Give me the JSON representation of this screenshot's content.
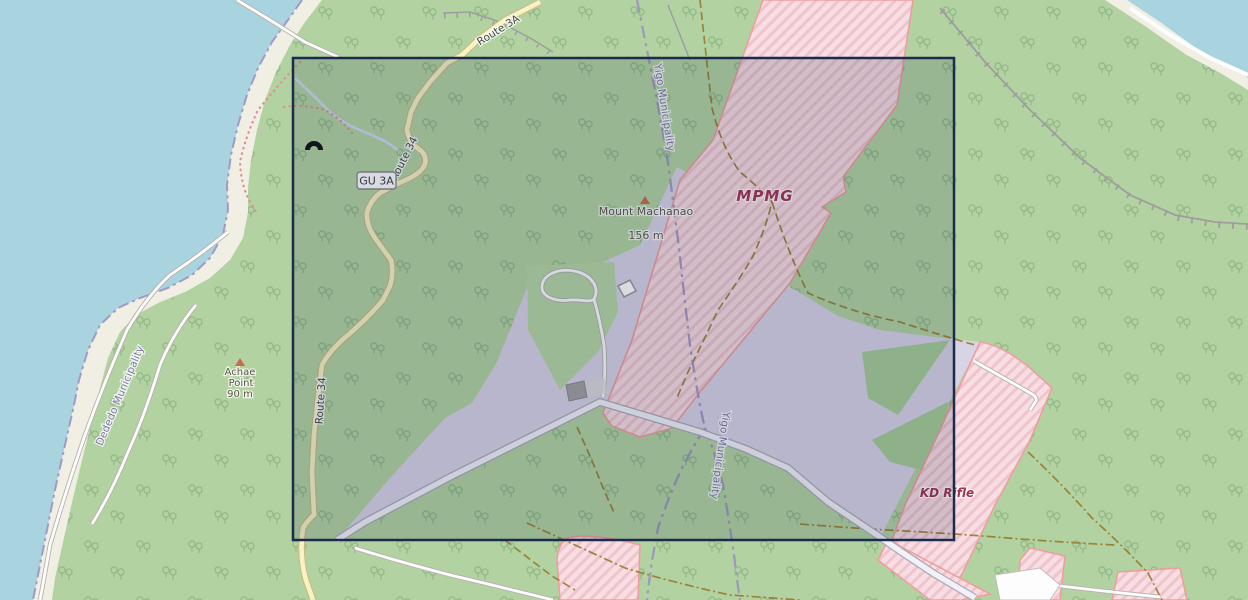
{
  "map": {
    "type": "openstreetmap-style terrain map with selection overlay",
    "labels": {
      "route_3a": "Route 3A",
      "route_34_upper": "Route 34",
      "route_34_lower": "Route 34",
      "shield_gu3a": "GU 3A",
      "peak1_name": "Mount Machanao",
      "peak1_elev": "156 m",
      "peak2_name_l1": "Achae",
      "peak2_name_l2": "Point",
      "peak2_elev": "90 m",
      "area_mpmg": "MPMG",
      "area_kd_rifle": "KD Rifle",
      "boundary_yigo_top": "Yigo Municipality",
      "boundary_yigo_lower": "Yigo Municipality",
      "boundary_dededo": "Dededo Municipality"
    },
    "icons": {
      "cave_entrance": "cave-entrance-icon",
      "peak_markers": "peak-triangle-icon"
    },
    "selection": {
      "x": 293,
      "y": 58,
      "width": 661,
      "height": 482
    },
    "colors": {
      "water": "#a9d3df",
      "beach": "#f1eee4",
      "woodland": "#b2d3a1",
      "tree_glyph": "#7fa878",
      "scrub": "#b7d6a4",
      "cleared_land_lavender": "#d9d3e6",
      "danger_area_fill": "#f8dde2",
      "danger_area_stripe": "#eec4cd",
      "danger_area_border": "#ee9e9e",
      "danger_label_text": "#a43352",
      "yellow_road_fill": "#f7f3c6",
      "yellow_road_casing": "#c9bd80",
      "white_road_fill": "#fdfdfd",
      "road_casing": "#b5b2ab",
      "boundary_purple": "#998fc0",
      "boundary_text": "#8278ad",
      "trail_brown": "#997a2e",
      "coast_trail_red": "#e08f8f",
      "cliff_gray": "#9e9e9e",
      "peak_marker": "#ca6a4a",
      "peak_text": "#5e5747",
      "selection_border": "#1c2b4d",
      "selection_fill": "rgba(25,40,80,0.17)",
      "stream": "#cdd9ee"
    }
  }
}
